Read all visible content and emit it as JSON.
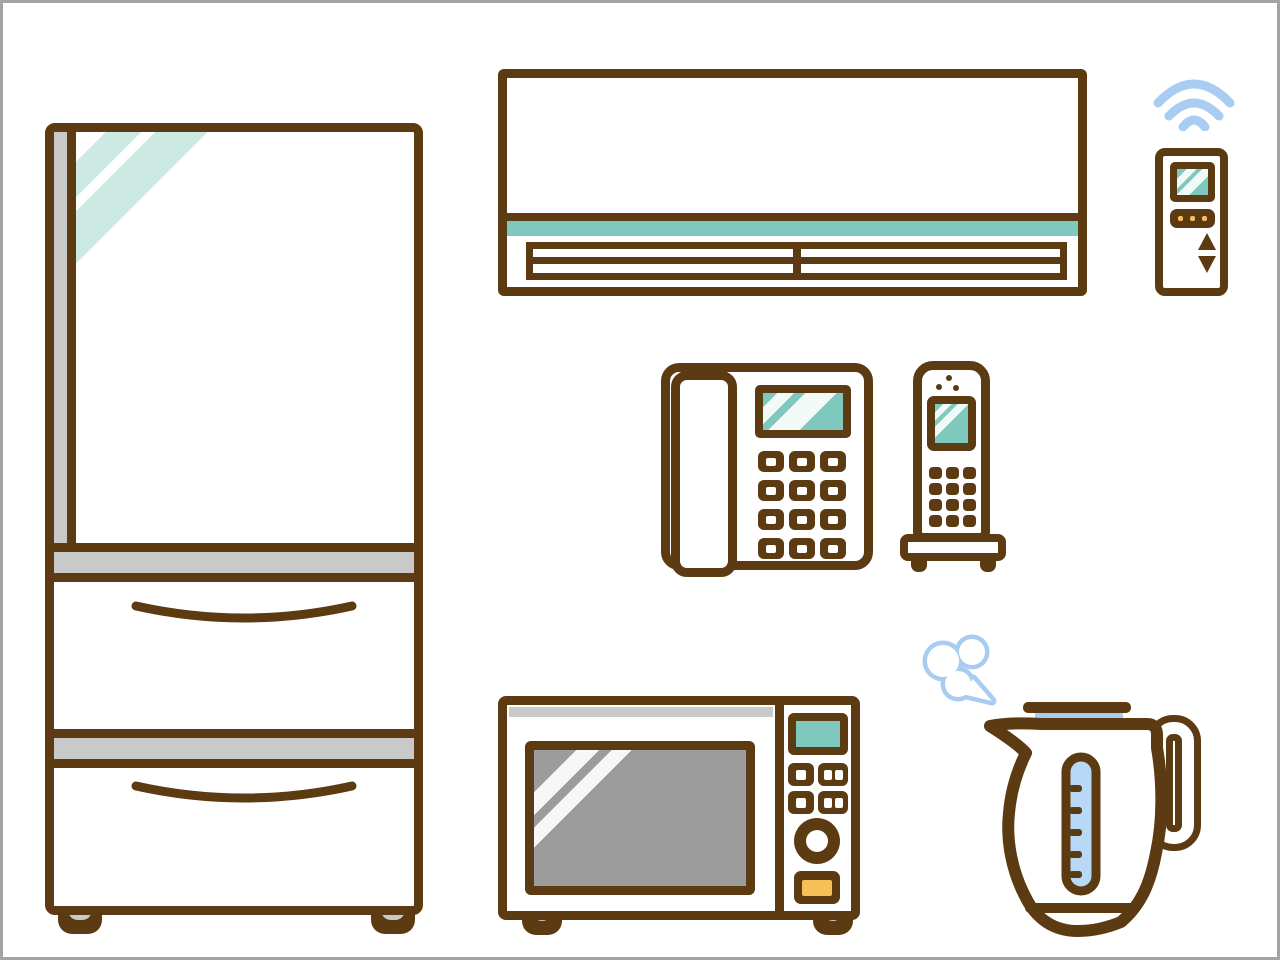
{
  "title": "Home appliances line illustration",
  "items": [
    {
      "id": "refrigerator",
      "label": "Refrigerator"
    },
    {
      "id": "air-conditioner",
      "label": "Air conditioner"
    },
    {
      "id": "ac-remote",
      "label": "Air conditioner remote control"
    },
    {
      "id": "wireless-signal",
      "label": "Wireless signal"
    },
    {
      "id": "corded-phone",
      "label": "Corded desk phone"
    },
    {
      "id": "cordless-phone",
      "label": "Cordless phone on charging base"
    },
    {
      "id": "microwave-oven",
      "label": "Microwave oven"
    },
    {
      "id": "electric-kettle",
      "label": "Electric kettle"
    },
    {
      "id": "steam-puff",
      "label": "Steam puff"
    }
  ],
  "colors": {
    "outline": "#5C3A12",
    "teal": "#7FC8BD",
    "mint": "#CDE9E3",
    "gray_light": "#C9C9C9",
    "gray_mid": "#9C9C9C",
    "orange": "#F7BF58",
    "blue": "#A9CDF2",
    "blue_fill": "#B7D8F6",
    "frame": "#A3A3A3",
    "background": "#FFFFFF"
  }
}
